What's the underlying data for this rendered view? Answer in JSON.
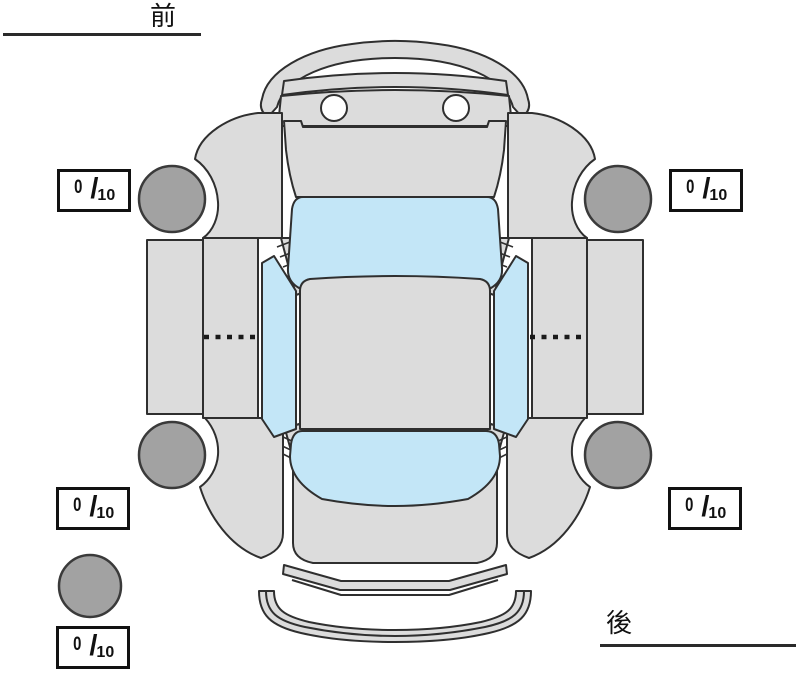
{
  "orientation": {
    "front_label": "前",
    "rear_label": "後"
  },
  "tread_boxes": {
    "separator": "/",
    "front_left": {
      "value": "0",
      "max": "10"
    },
    "front_right": {
      "value": "0",
      "max": "10"
    },
    "rear_left": {
      "value": "0",
      "max": "10"
    },
    "rear_right": {
      "value": "0",
      "max": "10"
    },
    "spare": {
      "value": "0",
      "max": "10"
    }
  },
  "colors": {
    "body_panel": "#dcdcdc",
    "glass": "#c3e6f7",
    "tire": "#a2a2a2",
    "outline": "#2f2f2f",
    "background": "#ffffff"
  }
}
